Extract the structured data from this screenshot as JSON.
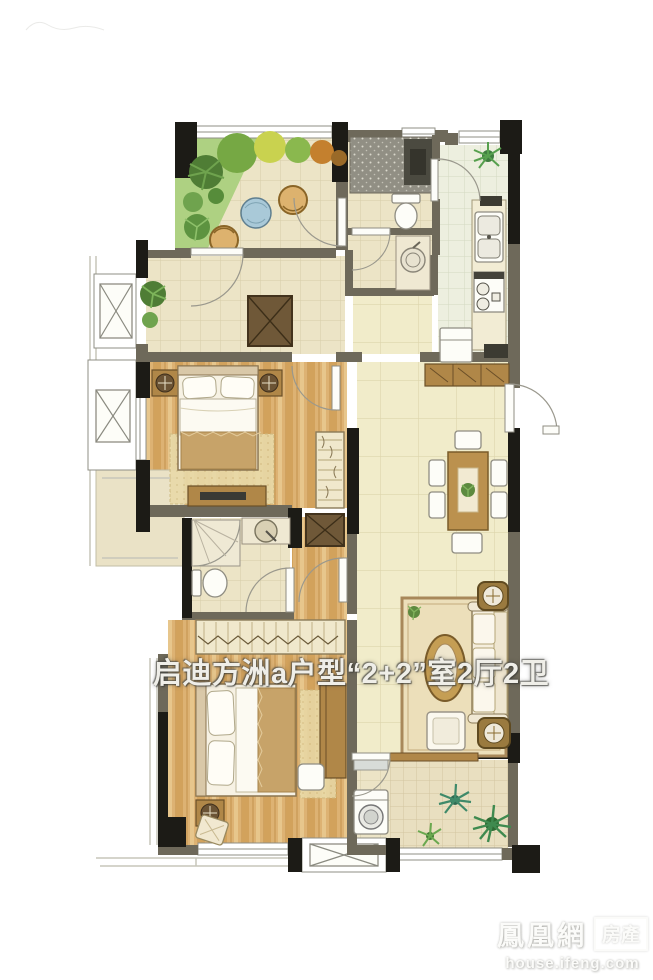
{
  "title": {
    "text": "启迪方洲a户型“2+2”室2厅2卫"
  },
  "watermark": {
    "brand": "鳳凰網",
    "badge": "房產",
    "domain": "house.ifeng.com"
  },
  "colors": {
    "wall": "#6e695a",
    "wall-dark": "#1c1b16",
    "title-text": "#efeee8",
    "watermark-text": "#fbfbf9",
    "wood-floor": "#ddb273",
    "tile-floor": "#ece4c6",
    "pale-floor": "#f1ecca",
    "garden-green": "#aed182",
    "accent-wood": "#b08748"
  }
}
